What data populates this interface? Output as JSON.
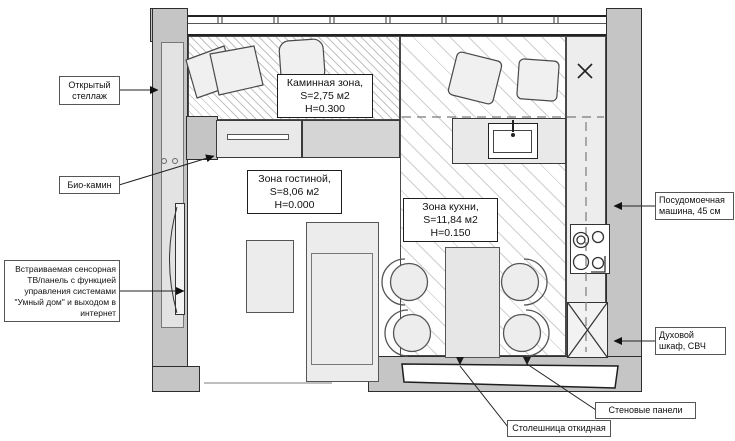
{
  "colors": {
    "wall": "#c5c5c5",
    "outline": "#2e2e2e",
    "counter": "#e9e9e9",
    "furniture": "#ececec",
    "leader": "#222222"
  },
  "zones": {
    "fireplace": {
      "line1": "Каминная зона,",
      "line2": "S=2,75 м2",
      "line3": "Н=0.300"
    },
    "living": {
      "line1": "Зона гостиной,",
      "line2": "S=8,06 м2",
      "line3": "Н=0.000"
    },
    "kitchen": {
      "line1": "Зона кухни,",
      "line2": "S=11,84 м2",
      "line3": "Н=0.150"
    }
  },
  "callouts": {
    "open_shelf": {
      "line1": "Открытый",
      "line2": "стеллаж"
    },
    "bio_fireplace": {
      "line1": "Био-камин"
    },
    "tv_panel": {
      "line1": "Встраиваемая сенсорная",
      "line2": "ТВ/панель с функцией",
      "line3": "управления системами",
      "line4": "\"Умный дом\" и выходом в",
      "line5": "интернет"
    },
    "dishwasher": {
      "line1": "Посудомоечная",
      "line2": "машина, 45 см"
    },
    "oven": {
      "line1": "Духовой",
      "line2": "шкаф, СВЧ"
    },
    "countertop": {
      "line1": "Столешница откидная"
    },
    "wall_panels": {
      "line1": "Стеновые панели"
    }
  }
}
